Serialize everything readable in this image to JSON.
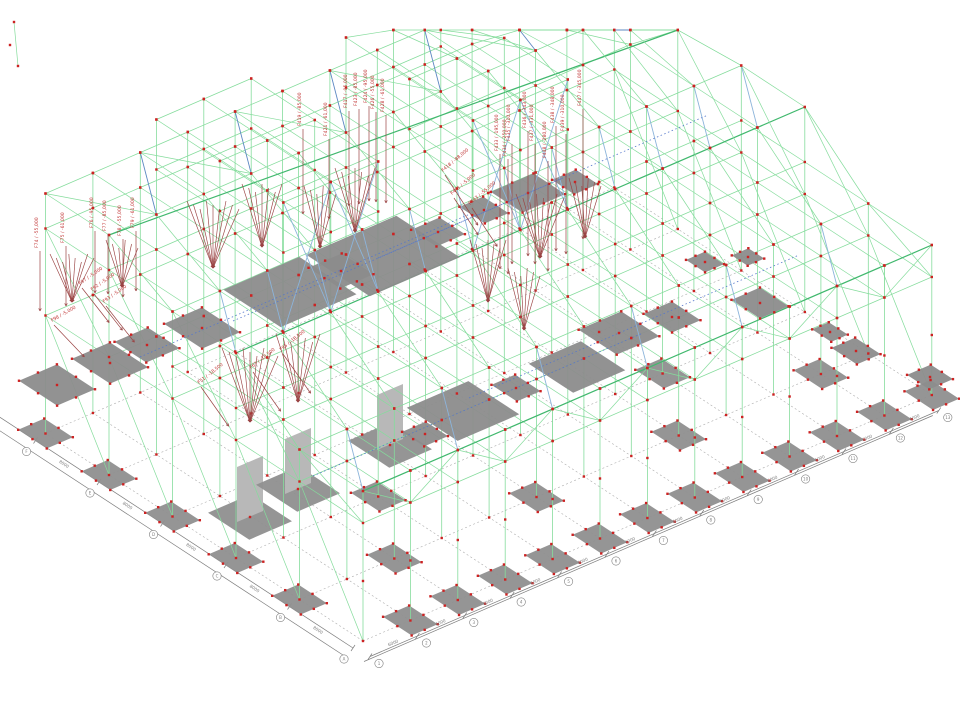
{
  "view": {
    "background": "#ffffff",
    "type": "isometric-structural-wireframe"
  },
  "colors": {
    "member_green": "#85dc9c",
    "member_green_dark": "#41b86e",
    "brace_blue": "#8cb4da",
    "brace_blue_dark": "#5d88c2",
    "node_red": "#cc2222",
    "load_arrow": "#9a4343",
    "load_text": "#c03333",
    "slab_gray": "#8c8c8c",
    "footing_gray": "#8f8f8f",
    "pedestal_gray": "#b8b8b8",
    "dim_gray": "#7d7d7d",
    "grid_dash": "#ababab",
    "dotted_blue": "#5577cc"
  },
  "axes": {
    "bottom": {
      "bay_label": "6000",
      "bubbles": [
        "1",
        "2",
        "3",
        "4",
        "5",
        "6",
        "7",
        "8",
        "9",
        "10",
        "11",
        "12",
        "13"
      ]
    },
    "left": {
      "bay_label": "8000",
      "bubbles": [
        "A",
        "B",
        "C",
        "D",
        "E",
        "F"
      ]
    }
  },
  "loads": [
    {
      "id": "F74",
      "value": "-55,000",
      "x": 38,
      "y": 248,
      "rot": -90,
      "len": 60
    },
    {
      "id": "F75",
      "value": "-61,000",
      "x": 64,
      "y": 243,
      "rot": -90,
      "len": 60
    },
    {
      "id": "F76",
      "value": "-95,000",
      "x": 93,
      "y": 228,
      "rot": -90,
      "len": 62
    },
    {
      "id": "F77",
      "value": "-85,000",
      "x": 106,
      "y": 231,
      "rot": -90,
      "len": 60
    },
    {
      "id": "F78",
      "value": "-55,000",
      "x": 121,
      "y": 236,
      "rot": -90,
      "len": 58
    },
    {
      "id": "F79",
      "value": "-61,000",
      "x": 134,
      "y": 228,
      "rot": -90,
      "len": 60
    },
    {
      "id": "F92",
      "value": "-5,000",
      "x": 92,
      "y": 291,
      "rot": -35,
      "len": 46
    },
    {
      "id": "F93",
      "value": "-5,000",
      "x": 104,
      "y": 303,
      "rot": -35,
      "len": 46
    },
    {
      "id": "F97",
      "value": "-5,000",
      "x": 80,
      "y": 285,
      "rot": -35,
      "len": 44
    },
    {
      "id": "F98",
      "value": "-5,000",
      "x": 52,
      "y": 322,
      "rot": -30,
      "len": 44
    },
    {
      "id": "F51",
      "value": "-18,500",
      "x": 199,
      "y": 384,
      "rot": -38,
      "len": 48
    },
    {
      "id": "F67",
      "value": "-18,500",
      "x": 251,
      "y": 369,
      "rot": -38,
      "len": 48
    },
    {
      "id": "F95",
      "value": "-18,500",
      "x": 281,
      "y": 351,
      "rot": -38,
      "len": 48
    },
    {
      "id": "F417",
      "value": "-95,000",
      "x": 347,
      "y": 108,
      "rot": -90,
      "len": 95
    },
    {
      "id": "F419",
      "value": "-85,000",
      "x": 301,
      "y": 126,
      "rot": -90,
      "len": 85
    },
    {
      "id": "F421",
      "value": "-61,000",
      "x": 327,
      "y": 136,
      "rot": -90,
      "len": 80
    },
    {
      "id": "F423",
      "value": "-85,000",
      "x": 357,
      "y": 106,
      "rot": -90,
      "len": 95
    },
    {
      "id": "F424",
      "value": "-95,000",
      "x": 367,
      "y": 103,
      "rot": -90,
      "len": 95
    },
    {
      "id": "F426",
      "value": "-55,000",
      "x": 374,
      "y": 109,
      "rot": -90,
      "len": 90
    },
    {
      "id": "F428",
      "value": "-61,000",
      "x": 384,
      "y": 112,
      "rot": -90,
      "len": 88
    },
    {
      "id": "F418",
      "value": "-88,000",
      "x": 443,
      "y": 172,
      "rot": -40,
      "len": 60
    },
    {
      "id": "F441",
      "value": "-5,000",
      "x": 452,
      "y": 195,
      "rot": -40,
      "len": 44
    },
    {
      "id": "F443",
      "value": "-55,000",
      "x": 470,
      "y": 205,
      "rot": -40,
      "len": 46
    },
    {
      "id": "F433",
      "value": "-195,000",
      "x": 498,
      "y": 151,
      "rot": -90,
      "len": 115
    },
    {
      "id": "F434",
      "value": "-250,000",
      "x": 506,
      "y": 156,
      "rot": -90,
      "len": 115
    },
    {
      "id": "F435",
      "value": "-310,000",
      "x": 510,
      "y": 141,
      "rot": -90,
      "len": 120
    },
    {
      "id": "F436",
      "value": "-343,000",
      "x": 526,
      "y": 128,
      "rot": -90,
      "len": 125
    },
    {
      "id": "F437",
      "value": "-331,000",
      "x": 533,
      "y": 141,
      "rot": -90,
      "len": 120
    },
    {
      "id": "F438",
      "value": "-348,000",
      "x": 554,
      "y": 123,
      "rot": -90,
      "len": 125
    },
    {
      "id": "F439",
      "value": "-310,000",
      "x": 564,
      "y": 131,
      "rot": -90,
      "len": 120
    },
    {
      "id": "F447",
      "value": "-345,000",
      "x": 581,
      "y": 106,
      "rot": -90,
      "len": 130
    },
    {
      "id": "F448",
      "value": "-280,000",
      "x": 546,
      "y": 158,
      "rot": -90,
      "len": 110
    }
  ]
}
